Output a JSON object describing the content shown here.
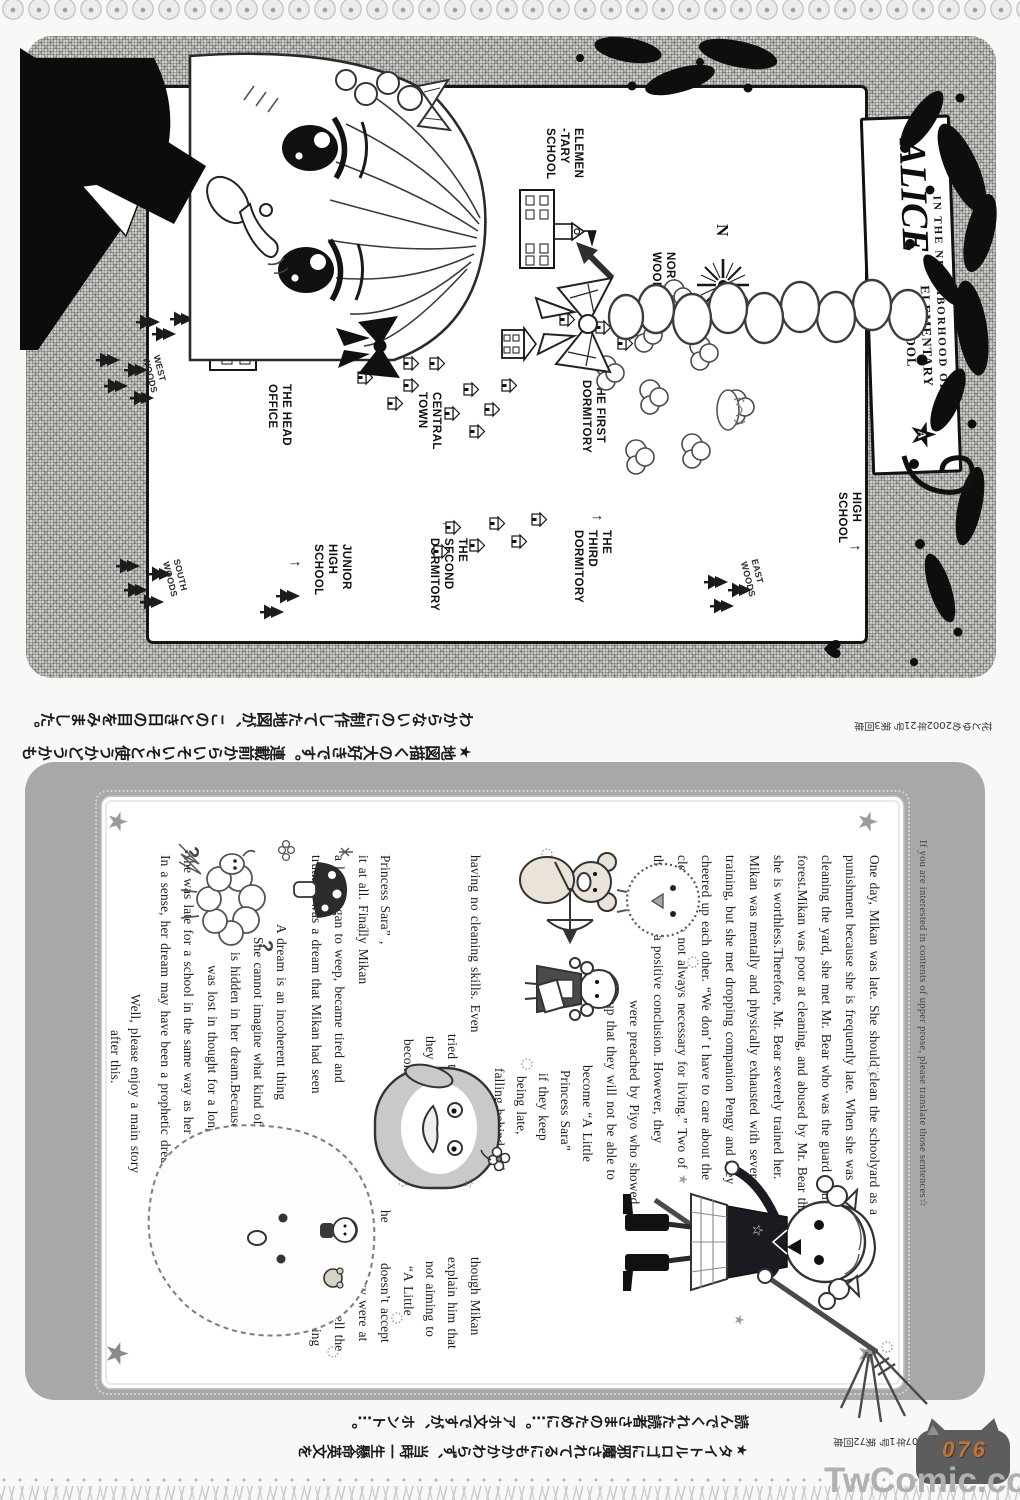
{
  "footer": {
    "watermark": "TwComic.com",
    "page_number": "076"
  },
  "panel1": {
    "credit": "花とゆめ2002年21号 第3回扉",
    "caption": "★地図描くの大好きです。連載前からいそいそと使うかどうかも\nわからないのに制作してた地図が、このとき日の目をみました。",
    "map_title": {
      "pre": "IN THE NEIGHBORHOOD OF",
      "main": "ALICE",
      "post": "ELEMENTARY SCHOOL",
      "badge_letter": "A",
      "badge_star": "★"
    },
    "map_labels": [
      {
        "id": "elementary-school",
        "x": 100,
        "y": 416,
        "t": "ELEMEN\n-TARY\nSCHOOL"
      },
      {
        "id": "northern-woods",
        "x": 224,
        "y": 324,
        "t": "NORTHERN\nWOODS"
      },
      {
        "id": "compass-n",
        "x": 196,
        "y": 268,
        "t": "N",
        "cls": "n"
      },
      {
        "id": "west-woods",
        "x": 328,
        "y": 834,
        "t": "WEST\nWOODS",
        "cls": "woods"
      },
      {
        "id": "head-office",
        "x": 356,
        "y": 708,
        "t": "THE HEAD\nOFFICE"
      },
      {
        "id": "central-town",
        "x": 364,
        "y": 558,
        "t": "CENTRAL\nTOWN"
      },
      {
        "id": "first-dormitory",
        "x": 352,
        "y": 394,
        "t": "THE FIRST\nDORMITORY"
      },
      {
        "id": "second-dormitory",
        "x": 510,
        "y": 532,
        "t": "THE\nSECOND\nDORMITORY"
      },
      {
        "id": "second-dormitory-arrow",
        "x": 492,
        "y": 544,
        "t": "↑",
        "cls": "arrow"
      },
      {
        "id": "junior-high-school",
        "x": 516,
        "y": 648,
        "t": "JUNIOR\nHIGH\nSCHOOL"
      },
      {
        "id": "junior-high-arrow",
        "x": 532,
        "y": 696,
        "t": "↑",
        "cls": "arrow"
      },
      {
        "id": "south-woods",
        "x": 532,
        "y": 814,
        "t": "SOUTH\nWOODS",
        "cls": "woods"
      },
      {
        "id": "third-dormitory",
        "x": 502,
        "y": 388,
        "t": "THE\nTHIRD\nDORMITORY"
      },
      {
        "id": "third-dormitory-arrow",
        "x": 486,
        "y": 394,
        "t": "↑",
        "cls": "arrow"
      },
      {
        "id": "east-woods",
        "x": 532,
        "y": 236,
        "t": "EAST\nWOODS",
        "cls": "woods"
      },
      {
        "id": "high-school",
        "x": 464,
        "y": 138,
        "t": "HIGH\nSCHOOL"
      },
      {
        "id": "high-school-arrow",
        "x": 516,
        "y": 136,
        "t": "↑",
        "cls": "arrow"
      }
    ]
  },
  "panel2": {
    "note": "If you are interested in contents of upper prose, please translate those sentences☆",
    "credit": "花とゆめ2007年1号 第72回扉",
    "caption": "★タイトルロゴに邪魔されてるにもかかわらず、当時一生懸命英文を\n読んでくれた読者さまのために…。アホ文ですが、ホント…。",
    "prose_lines": [
      {
        "x": 93,
        "y": 103,
        "t": "One day,  Mikan was late.  She should clean the schoolyard as a"
      },
      {
        "x": 93,
        "y": 127,
        "t": "punishment  because she is frequently late.   When she was"
      },
      {
        "x": 93,
        "y": 151,
        "t": "cleaning the yard,  she met  Mr. Bear who was the guard in the"
      },
      {
        "x": 93,
        "y": 175,
        "t": "forest.Mikan was poor at cleaning, and  abused by Mr. Bear that"
      },
      {
        "x": 93,
        "y": 199,
        "t": "she is worthless.Therefore, Mr. Bear severely  trained her."
      },
      {
        "x": 93,
        "y": 223,
        "t": "Mikan was mentally and physically exhausted with severe"
      },
      {
        "x": 93,
        "y": 247,
        "t": "training,  but she met dropping companion Pengy  and they"
      },
      {
        "x": 93,
        "y": 271,
        "t": "cheered up  each other.  “We don’ t have to care about the"
      },
      {
        "x": 93,
        "y": 295,
        "t": "cleaning.  It is not always  necessary for living.”  Two of"
      },
      {
        "x": 93,
        "y": 319,
        "t": "them reached a positive conclusion.  However,  they"
      },
      {
        "x": 238,
        "y": 343,
        "t": "were preached by Piyo who showed"
      },
      {
        "x": 240,
        "y": 366,
        "t": "up that they will not be able to"
      },
      {
        "x": 303,
        "y": 390,
        "t": "become  “A Little"
      },
      {
        "x": 308,
        "y": 412,
        "t": "Princess Sara”"
      },
      {
        "x": 311,
        "y": 434,
        "t": "if they keep"
      },
      {
        "x": 314,
        "y": 456,
        "t": "being late,"
      },
      {
        "x": 306,
        "y": 478,
        "t": "falling behind and"
      },
      {
        "x": 93,
        "y": 502,
        "t": "having no cleaning skills. Even"
      },
      {
        "x": 495,
        "y": 502,
        "t": "though Mikan"
      },
      {
        "x": 272,
        "y": 525,
        "t": "tried to"
      },
      {
        "x": 495,
        "y": 525,
        "t": "explain him that"
      },
      {
        "x": 274,
        "y": 547,
        "t": "they are"
      },
      {
        "x": 499,
        "y": 547,
        "t": "not aiming to"
      },
      {
        "x": 277,
        "y": 569,
        "t": "become"
      },
      {
        "x": 504,
        "y": 569,
        "t": "“A Little"
      },
      {
        "x": 93,
        "y": 592,
        "t": "Princess Sara” ,"
      },
      {
        "x": 448,
        "y": 592,
        "t": "he"
      },
      {
        "x": 501,
        "y": 592,
        "t": "doesn’t accept"
      },
      {
        "x": 93,
        "y": 614,
        "t": "it at all. Finally Mikan"
      },
      {
        "x": 448,
        "y": 614,
        "t": "and"
      },
      {
        "x": 499,
        "y": 614,
        "t": "Pengy were at"
      },
      {
        "x": 93,
        "y": 638,
        "t": "a loss,  began to weep,  became tired and"
      },
      {
        "x": 488,
        "y": 638,
        "t": "slept.―To tell the"
      },
      {
        "x": 93,
        "y": 661,
        "t": "truth, it was a dream that Mikan had seen"
      },
      {
        "x": 494,
        "y": 661,
        "t": "on that morning"
      },
      {
        "x": 162,
        "y": 696,
        "t": "A dream is an incoherent thing"
      },
      {
        "x": 175,
        "y": 719,
        "t": "She cannot imagine what kind of  message"
      },
      {
        "x": 190,
        "y": 742,
        "t": "is hidden in her dream.Because she"
      },
      {
        "x": 203,
        "y": 765,
        "t": "was lost in thought for a  long time,"
      },
      {
        "x": 93,
        "y": 789,
        "t": "she was late for a school in the same way as her dream."
      },
      {
        "x": 93,
        "y": 812,
        "t": "In a  sense, her dream may have been a prophetic dream."
      },
      {
        "x": 232,
        "y": 842,
        "t": "Well, please enjoy a  main story"
      },
      {
        "x": 268,
        "y": 862,
        "t": "after this."
      }
    ]
  }
}
